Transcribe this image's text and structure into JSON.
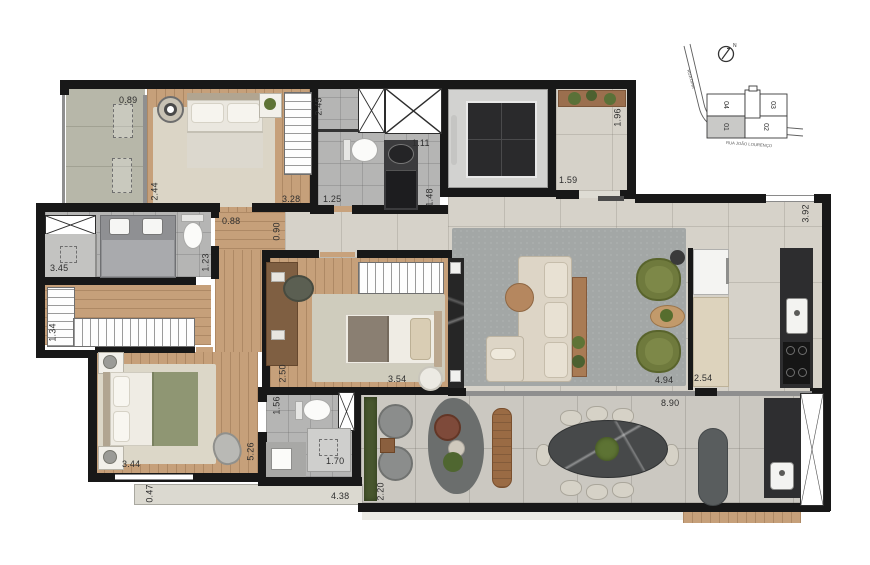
{
  "plan": {
    "dims": {
      "varanda": "0.89",
      "bedroom1_d": "2.44",
      "bedroom1_w": "3.28",
      "bath1_w": "1.25",
      "bath1_d": "2.45",
      "bath1_a": "1.11",
      "bath1_b": "1.48",
      "hall_w": "1.96",
      "hall_d": "1.59",
      "kitchen_d": "3.92",
      "corr_a": "0.88",
      "corr_b": "0.90",
      "mbath_a": "1.23",
      "mbath_w": "3.45",
      "closet_d": "1.34",
      "suite2_d": "2.50",
      "suite2_w": "3.54",
      "living_w": "4.94",
      "kitchen_w": "2.54",
      "terrace_w": "8.90",
      "master_w": "3.44",
      "master_d": "5.26",
      "balcony2": "0.47",
      "hall2": "1.56",
      "bath2_w": "1.70",
      "terrace_a": "4.38",
      "terrace_b": "2.20"
    }
  },
  "site_plan": {
    "compass_label": "N",
    "street_diagonal": "RUA DINA",
    "street_bottom": "RUA JOÃO LOURENÇO",
    "units": [
      {
        "id": "04"
      },
      {
        "id": "03"
      },
      {
        "id": "01"
      },
      {
        "id": "02"
      }
    ],
    "highlighted_unit": "01"
  }
}
